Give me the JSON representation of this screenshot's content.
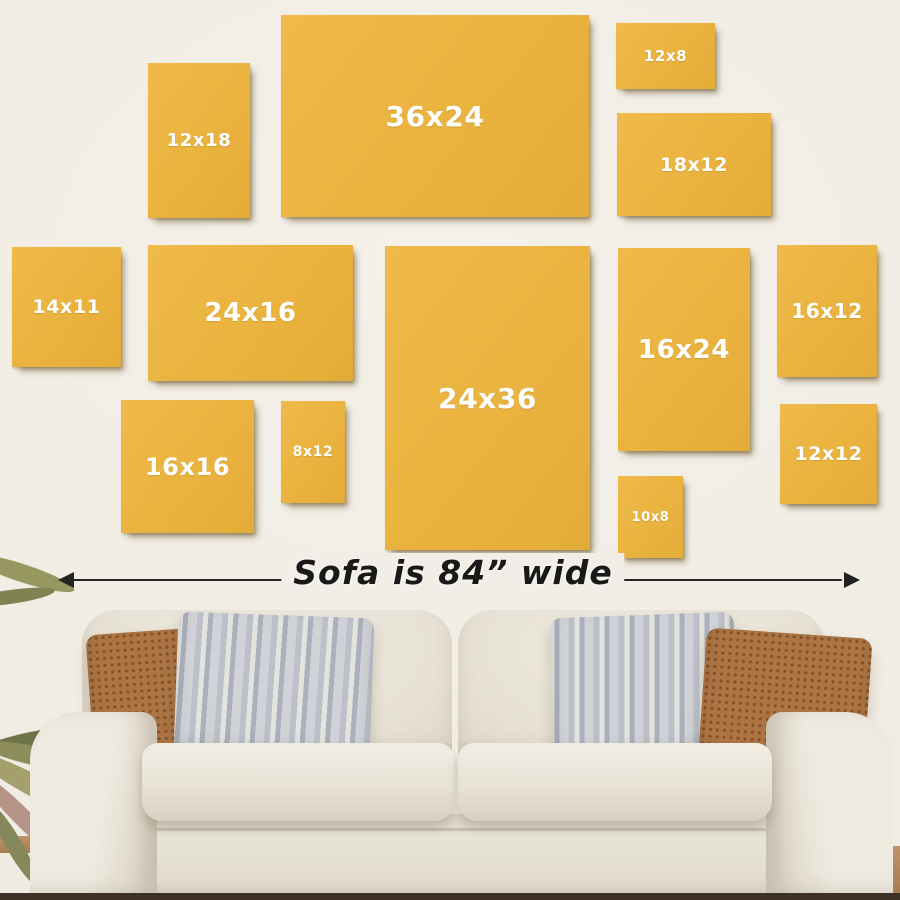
{
  "page": {
    "wall_color": "#f2eee7",
    "floor_color": "#3e3026"
  },
  "size_guide": {
    "title": "Canvas size comparison above sofa",
    "unit": "inches",
    "canvas_color": "#eab33f",
    "label_color": "#ffffff",
    "canvases": [
      {
        "label": "12x18",
        "x": 148,
        "y": 63,
        "w": 102,
        "h": 155,
        "fs": 18
      },
      {
        "label": "36x24",
        "x": 281,
        "y": 15,
        "w": 308,
        "h": 202,
        "fs": 28
      },
      {
        "label": "12x8",
        "x": 616,
        "y": 23,
        "w": 99,
        "h": 66,
        "fs": 15
      },
      {
        "label": "18x12",
        "x": 617,
        "y": 113,
        "w": 154,
        "h": 103,
        "fs": 19
      },
      {
        "label": "14x11",
        "x": 12,
        "y": 247,
        "w": 109,
        "h": 120,
        "fs": 19
      },
      {
        "label": "24x16",
        "x": 148,
        "y": 245,
        "w": 205,
        "h": 136,
        "fs": 26
      },
      {
        "label": "24x36",
        "x": 385,
        "y": 246,
        "w": 205,
        "h": 304,
        "fs": 28
      },
      {
        "label": "16x24",
        "x": 618,
        "y": 248,
        "w": 132,
        "h": 203,
        "fs": 26
      },
      {
        "label": "16x12",
        "x": 777,
        "y": 245,
        "w": 100,
        "h": 132,
        "fs": 20
      },
      {
        "label": "16x16",
        "x": 121,
        "y": 400,
        "w": 133,
        "h": 133,
        "fs": 24
      },
      {
        "label": "8x12",
        "x": 281,
        "y": 401,
        "w": 64,
        "h": 102,
        "fs": 14
      },
      {
        "label": "10x8",
        "x": 618,
        "y": 476,
        "w": 65,
        "h": 82,
        "fs": 13
      },
      {
        "label": "12x12",
        "x": 780,
        "y": 404,
        "w": 97,
        "h": 100,
        "fs": 19
      }
    ]
  },
  "sofa": {
    "caption": "Sofa is 84” wide",
    "arrow_color": "#232323",
    "fabric_color": "#e8e2d6",
    "pillow_colors": {
      "rust": "#ac7543",
      "gray_stripe": "#bcc0c8"
    }
  }
}
